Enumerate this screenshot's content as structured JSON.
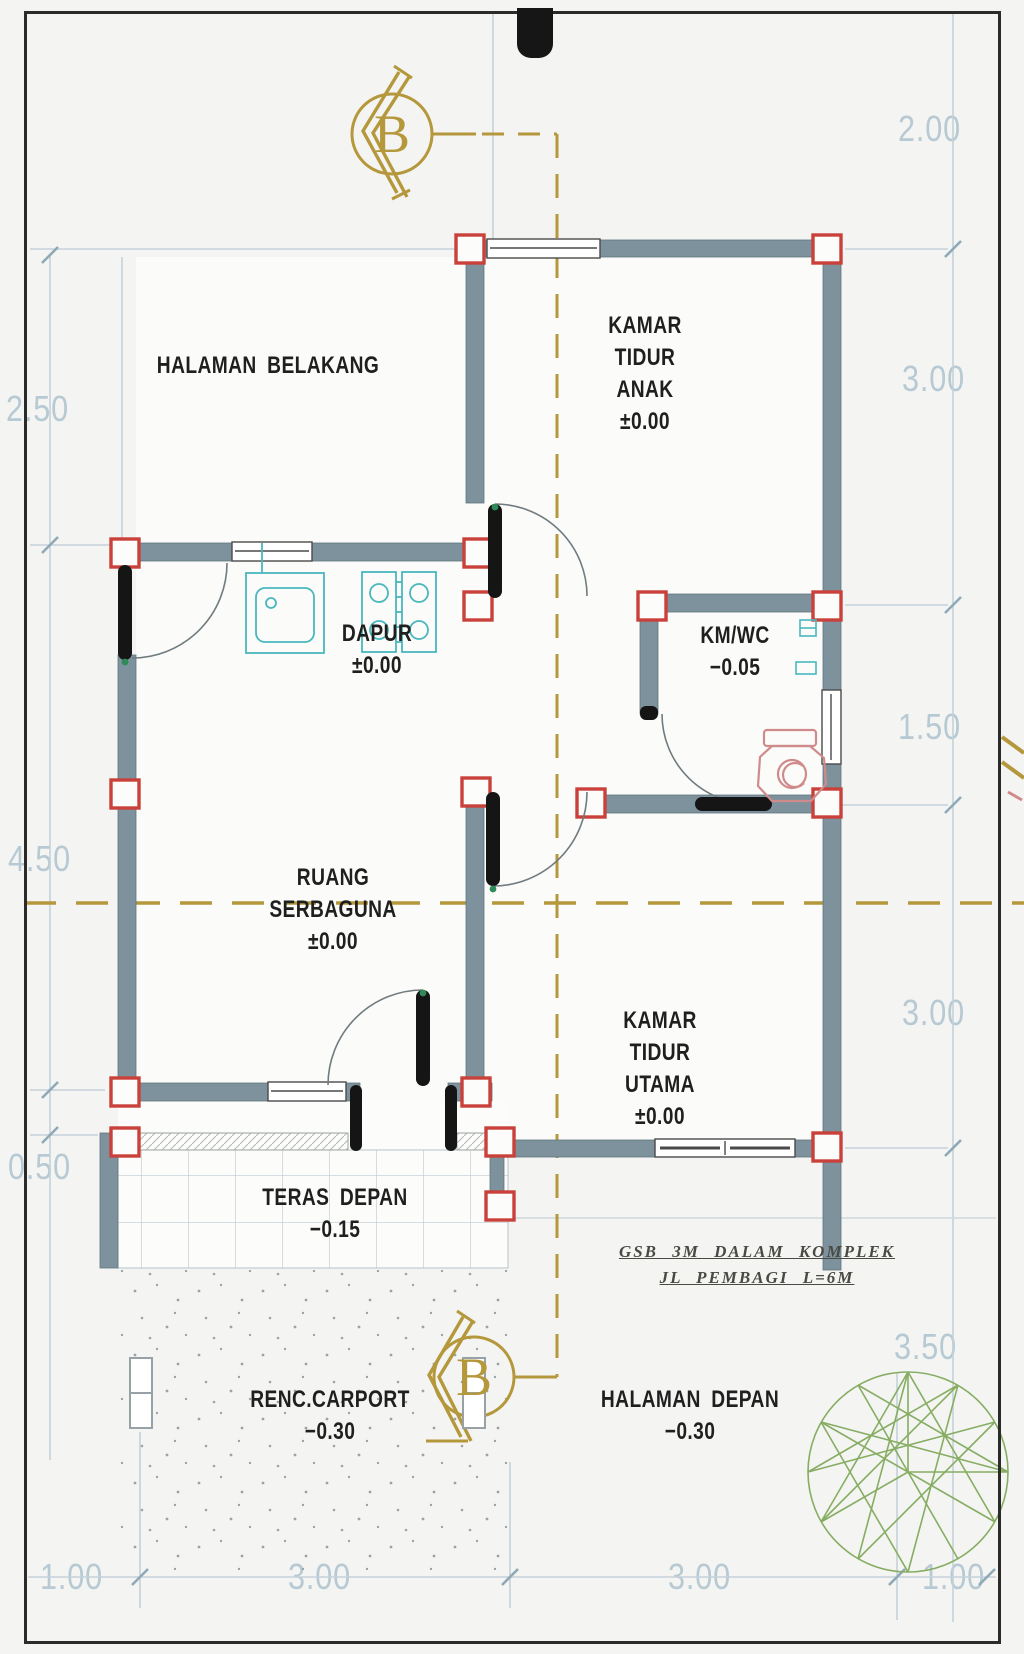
{
  "sheet": {
    "type": "architectural-floor-plan",
    "language": "Indonesian"
  },
  "rooms": [
    {
      "name": "halaman-belakang",
      "lines": [
        "HALAMAN BELAKANG"
      ]
    },
    {
      "name": "kamar-tidur-anak",
      "lines": [
        "KAMAR",
        "TIDUR",
        "ANAK",
        "±0.00"
      ]
    },
    {
      "name": "dapur",
      "lines": [
        "DAPUR",
        "±0.00"
      ]
    },
    {
      "name": "km-wc",
      "lines": [
        "KM/WC",
        "−0.05"
      ]
    },
    {
      "name": "ruang-serbaguna",
      "lines": [
        "RUANG",
        "SERBAGUNA",
        "±0.00"
      ]
    },
    {
      "name": "kamar-tidur-utama",
      "lines": [
        "KAMAR",
        "TIDUR",
        "UTAMA",
        "±0.00"
      ]
    },
    {
      "name": "teras-depan",
      "lines": [
        "TERAS DEPAN",
        "−0.15"
      ]
    },
    {
      "name": "renc-carport",
      "lines": [
        "RENC.CARPORT",
        "−0.30"
      ]
    },
    {
      "name": "halaman-depan",
      "lines": [
        "HALAMAN DEPAN",
        "−0.30"
      ]
    }
  ],
  "dimensions": {
    "left": [
      "2.50",
      "4.50",
      "0.50"
    ],
    "right": [
      "2.00",
      "3.00",
      "1.50",
      "3.00",
      "3.50"
    ],
    "bottom": [
      "1.00",
      "3.00",
      "3.00",
      "1.00"
    ]
  },
  "section": {
    "markers": [
      {
        "label": "B",
        "position": "top"
      },
      {
        "label": "B",
        "position": "bottom"
      }
    ]
  },
  "setback_note": {
    "lines": [
      "GSB 3M DALAM KOMPLEK",
      "JL PEMBAGI L=6M"
    ]
  },
  "symbols": [
    "column-marker",
    "door-swing",
    "window",
    "kitchen-sink",
    "stove",
    "toilet",
    "tree",
    "section-arrow"
  ],
  "colors": {
    "wall": "#7e929d",
    "wall_edge": "#60767f",
    "column_red": "#c9413a",
    "gold": "#b5983c",
    "dim_blue": "#b7c9d3",
    "guide_blue": "#c3d2da",
    "fixture_cyan": "#49b8be",
    "toilet_pink": "#cf8b8b",
    "tree_green": "#86ad62",
    "ink": "#1f1f1f"
  }
}
